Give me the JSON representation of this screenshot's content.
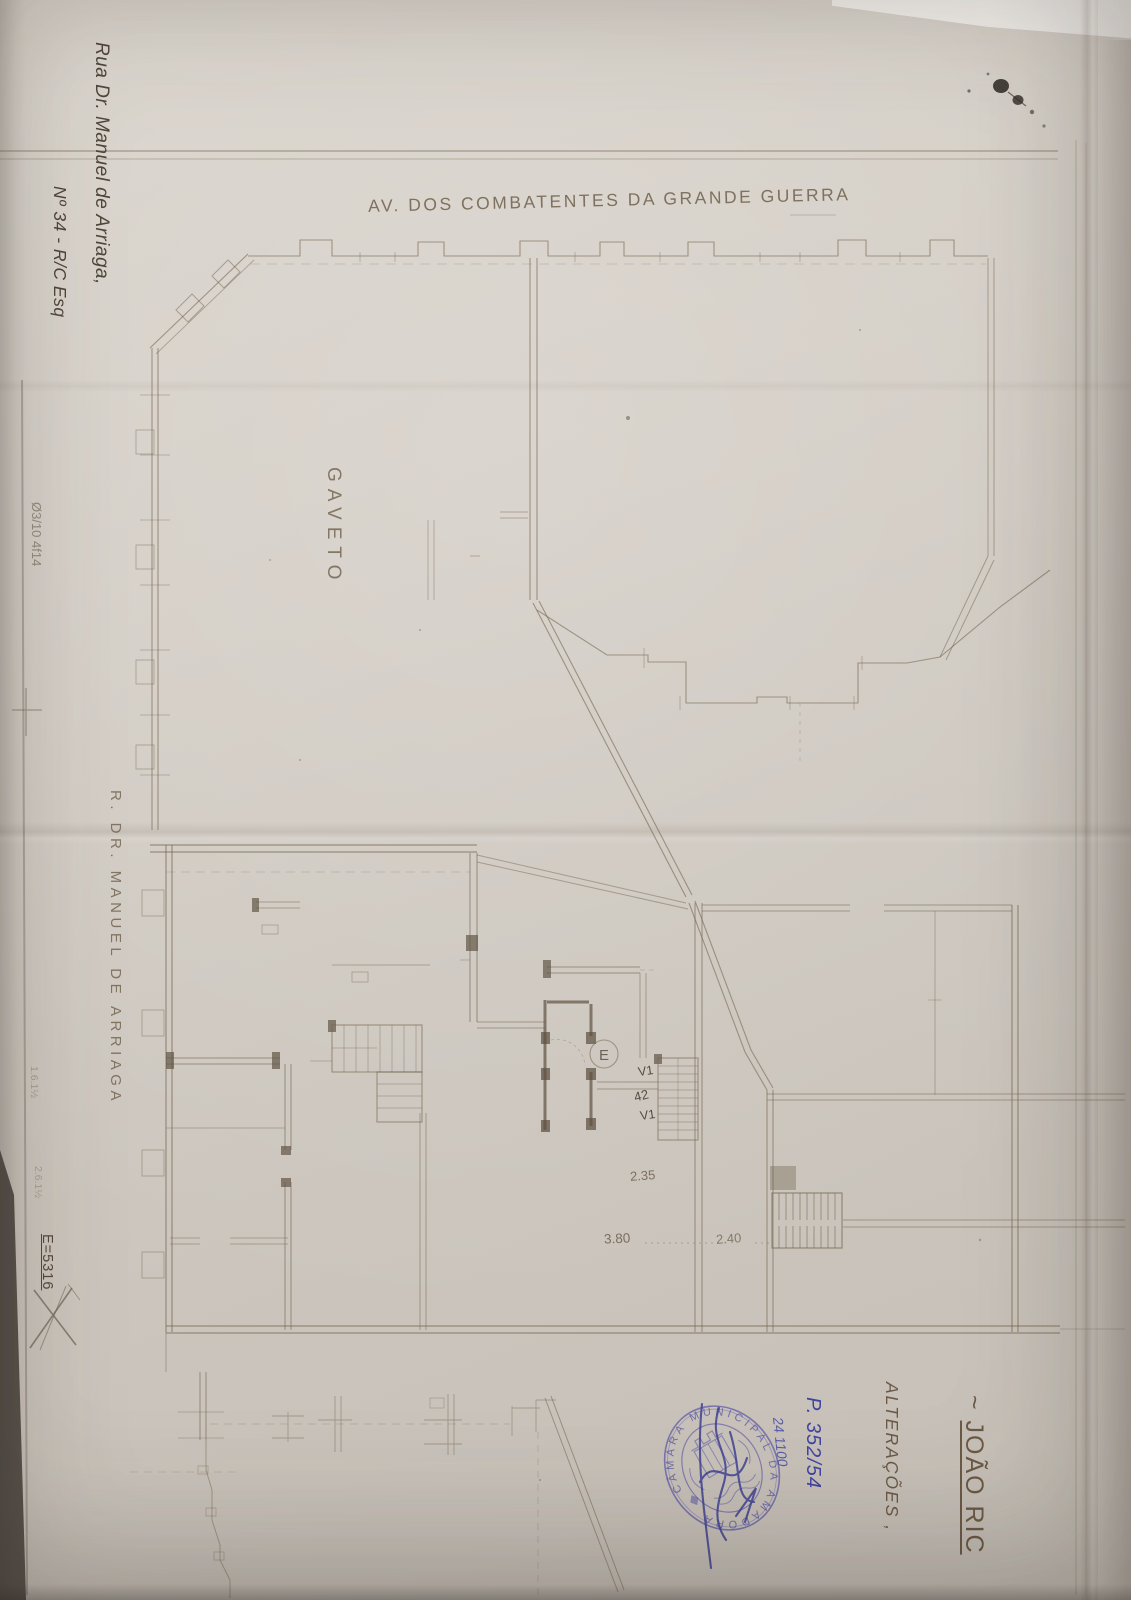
{
  "plan": {
    "street_top_label": "AV. DOS COMBATENTES DA GRANDE GUERRA",
    "street_left_label": "R. DR. MANUEL DE ARRIAGA",
    "corner_label": "GAVETO",
    "dim_235": "2.35",
    "dim_380": "3.80",
    "dim_240": "2.40",
    "stair_label_v1_top": "V1",
    "stair_label_mid": "42",
    "stair_label_v1_bottom": "V1",
    "elevator_label": "E"
  },
  "annotations": {
    "address_line1": "Rua Dr. Manuel de Arriaga,",
    "address_line2": "Nº 34 - R/C Esq",
    "title_prefix": "~ ",
    "title_name": "JOÃO RIC",
    "subtitle": "ALTERAÇÕES ,",
    "process_number": "P. 352/54",
    "date_scribble": "24 1100",
    "file_mark": "E=5316",
    "pencil_note": "Ø3/10 4f14",
    "pencil_faint_1": "1.6.1½",
    "pencil_faint_2": "2.6.1½"
  },
  "stamp": {
    "ring_text": "CÂMARA MUNICIPAL DA AMADORA",
    "ink_color": "#5d57a6"
  }
}
